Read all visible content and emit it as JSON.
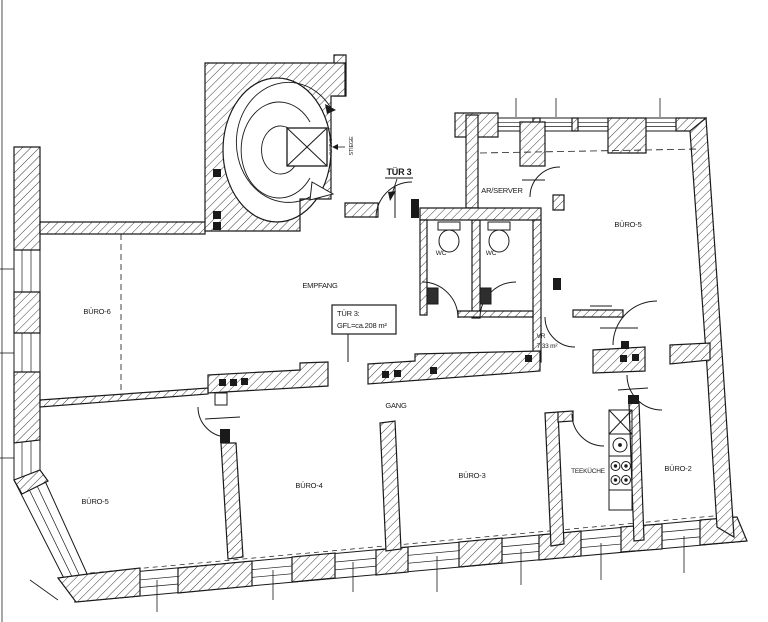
{
  "plan": {
    "colors": {
      "background": "#ffffff",
      "line": "#1a1a1a",
      "hatch": "#3c3c3c"
    },
    "door_label": "TÜR 3",
    "info_box": {
      "line1": "TÜR 3:",
      "line2": "GFL=ca.208 m²"
    },
    "stairwell": {
      "stair_label": "STIEGE",
      "elevator_label": "AUFZUG"
    },
    "rooms": {
      "empfang": "EMPFANG",
      "buero6": "BÜRO-6",
      "buero5_top": "BÜRO-5",
      "ar_server": "AR/SERVER",
      "wc_left": "WC",
      "wc_right": "WC",
      "vr": "VR",
      "vr_area": "7.33 m²",
      "gang": "GANG",
      "buero5_bottom": "BÜRO-5",
      "buero4": "BÜRO-4",
      "buero3": "BÜRO-3",
      "teekueche": "TEEKÜCHE",
      "buero2": "BÜRO-2"
    }
  }
}
